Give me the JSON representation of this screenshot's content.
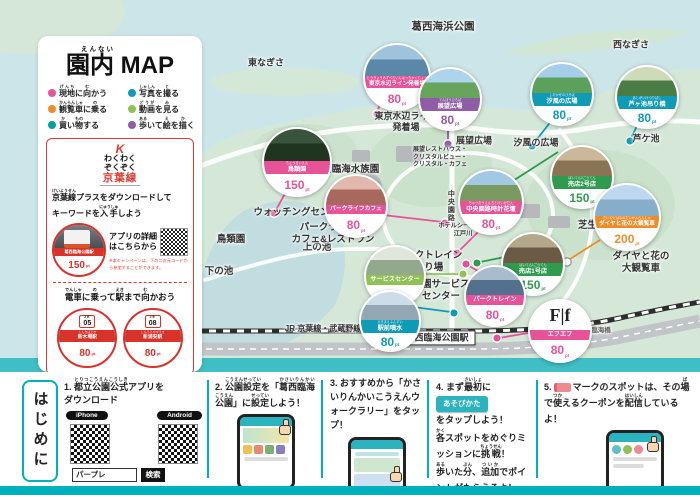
{
  "colors": {
    "teal": "#00b0ba",
    "red": "#dd3b30",
    "pink": "#e85298",
    "blue": "#0f9bb5",
    "purple": "#8f5ca6",
    "orange": "#ef8c2a",
    "green": "#2e9b4e",
    "light_green": "#8fc155",
    "dark_teal": "#00a297"
  },
  "left_panel": {
    "title": {
      "text": "園内 MAP",
      "furigana": "えんない"
    },
    "legend": [
      {
        "segs": [
          {
            "t": "現地",
            "r": "げんち"
          },
          {
            "t": "に"
          },
          {
            "t": "向",
            "r": "む"
          },
          {
            "t": "かう"
          }
        ],
        "color": "#e85298"
      },
      {
        "segs": [
          {
            "t": "写真",
            "r": "しゃしん"
          },
          {
            "t": "を"
          },
          {
            "t": "撮",
            "r": "と"
          },
          {
            "t": "る"
          }
        ],
        "color": "#0f9bb5"
      },
      {
        "segs": [
          {
            "t": "観覧車",
            "r": "かんらんしゃ"
          },
          {
            "t": "に"
          },
          {
            "t": "乗",
            "r": "の"
          },
          {
            "t": "る"
          }
        ],
        "color": "#ef8c2a"
      },
      {
        "segs": [
          {
            "t": "動画",
            "r": "どうが"
          },
          {
            "t": "を"
          },
          {
            "t": "見",
            "r": "み"
          },
          {
            "t": "る"
          }
        ],
        "color": "#8fc155"
      },
      {
        "segs": [
          {
            "t": "買",
            "r": "か"
          },
          {
            "t": "い"
          },
          {
            "t": "物",
            "r": "もの"
          },
          {
            "t": "する"
          }
        ],
        "color": "#00a297"
      },
      {
        "segs": [
          {
            "t": "歩",
            "r": "ある"
          },
          {
            "t": "いて"
          },
          {
            "t": "絵",
            "r": "え"
          },
          {
            "t": "を"
          },
          {
            "t": "描",
            "r": "か"
          },
          {
            "t": "く"
          }
        ],
        "color": "#8f5ca6"
      }
    ],
    "keiyo": {
      "logo_mark": "K",
      "logo_line1": "わくわく",
      "logo_line2": "ぞくぞく",
      "logo_line3": "京葉線",
      "headline": [
        {
          "t": "京葉線",
          "r": "けいようせん"
        },
        {
          "t": "プラスをダウンロードして\nキーワードを"
        },
        {
          "t": "入手",
          "r": "にゅうしゅ"
        },
        {
          "t": "しよう"
        }
      ],
      "station_badge": {
        "name": "葛西臨海公園駅",
        "points": "150",
        "unit": "pt"
      },
      "detail_line1": "アプリの詳細",
      "detail_line2": "はこちらから",
      "note": "※本キャンペーンは、下の二次元コードから参加することができます。",
      "train_heading": [
        {
          "t": "電車",
          "r": "でんしゃ"
        },
        {
          "t": "に"
        },
        {
          "t": "乗",
          "r": "の"
        },
        {
          "t": "って"
        },
        {
          "t": "駅",
          "r": "えき"
        },
        {
          "t": "まで"
        },
        {
          "t": "向",
          "r": "む"
        },
        {
          "t": "かおう"
        }
      ],
      "stations": [
        {
          "code_line": "JE",
          "code_num": "05",
          "furigana": "しんきばえき",
          "name": "新木場駅",
          "points": "80",
          "unit": "pt"
        },
        {
          "code_line": "JE",
          "code_num": "08",
          "furigana": "しんうらやすえき",
          "name": "新浦安駅",
          "points": "80",
          "unit": "pt"
        }
      ]
    }
  },
  "map": {
    "points_unit": "pt",
    "labels": [
      {
        "text": "葛西海浜公園",
        "x": 443,
        "y": 27,
        "size": 10.5
      },
      {
        "text": "東なぎさ",
        "x": 266,
        "y": 63,
        "size": 9
      },
      {
        "text": "西なぎさ",
        "x": 631,
        "y": 45,
        "size": 9
      },
      {
        "text": "東京水辺ライン\n発着場",
        "x": 406,
        "y": 122,
        "size": 9
      },
      {
        "text": "展望広場",
        "x": 474,
        "y": 141,
        "size": 9
      },
      {
        "text": "汐風の広場",
        "x": 536,
        "y": 143,
        "size": 9
      },
      {
        "text": "芦ケ池",
        "x": 646,
        "y": 139,
        "size": 9
      },
      {
        "text": "葛西臨海水族園",
        "x": 346,
        "y": 170,
        "size": 9.5
      },
      {
        "text": "展望レストハウス・\nクリスタルビュー・\nクリスタル・カフェ",
        "x": 440,
        "y": 158,
        "size": 6
      },
      {
        "text": "ウォッチングセンター",
        "x": 301,
        "y": 213,
        "size": 9.5
      },
      {
        "text": "鳥類園",
        "x": 231,
        "y": 240,
        "size": 9.5
      },
      {
        "text": "上の池",
        "x": 317,
        "y": 248,
        "size": 9.5
      },
      {
        "text": "下の池",
        "x": 219,
        "y": 272,
        "size": 9.5
      },
      {
        "text": "中央園路",
        "x": 450,
        "y": 206,
        "size": 7,
        "vertical": true
      },
      {
        "text": "ホテルシーサイド\n江戸川",
        "x": 463,
        "y": 230,
        "size": 6.2
      },
      {
        "text": "パークライフ・\nカフェ&レストラン",
        "x": 333,
        "y": 234,
        "size": 9.5
      },
      {
        "text": "パークトレイン\n乗り場",
        "x": 429,
        "y": 262,
        "size": 9.5
      },
      {
        "text": "公園サービス\nセンター",
        "x": 441,
        "y": 291,
        "size": 9.5
      },
      {
        "text": "芝生広場",
        "x": 597,
        "y": 226,
        "size": 9.5
      },
      {
        "text": "ダイヤと花の大観覧車",
        "x": 641,
        "y": 263,
        "size": 9.5
      },
      {
        "text": "臨海橋",
        "x": 601,
        "y": 331,
        "size": 6.5,
        "color": "#666"
      },
      {
        "text": "JR 京葉線・武蔵野線",
        "x": 323,
        "y": 329,
        "size": 8
      },
      {
        "text": "葛西臨海公園駅",
        "x": 437,
        "y": 338,
        "size": 9,
        "boxed": true
      }
    ],
    "spots": [
      {
        "name": "東京水辺ライン発着場",
        "furigana": "とうきょうみずべらいんはっちゃくじょう",
        "points": "80",
        "color": "#e85298",
        "x": 363,
        "y": 43,
        "d": 64,
        "photo": [
          "#9fc3dd",
          "#5b87a8"
        ]
      },
      {
        "name": "展望広場",
        "furigana": "てんぼうひろば",
        "points": "80",
        "color": "#8f5ca6",
        "x": 418,
        "y": 67,
        "d": 60,
        "photo": [
          "#aed3ec",
          "#67a45c"
        ]
      },
      {
        "name": "汐風の広場",
        "furigana": "しおかぜのひろば",
        "points": "80",
        "color": "#0f9bb5",
        "x": 530,
        "y": 62,
        "d": 60,
        "photo": [
          "#a5cee9",
          "#5ba05b"
        ]
      },
      {
        "name": "芦ヶ池吊り橋",
        "furigana": "あしがいけつりばし",
        "points": "80",
        "color": "#0f9bb5",
        "x": 615,
        "y": 65,
        "d": 60,
        "photo": [
          "#cddbb8",
          "#4a7c46"
        ]
      },
      {
        "name": "鳥類園",
        "furigana": "ちょうるいえん",
        "points": "150",
        "color": "#e85298",
        "x": 262,
        "y": 127,
        "d": 66,
        "photo": [
          "#39543c",
          "#20351f"
        ]
      },
      {
        "name": "パークライフカフェ",
        "points": "80",
        "color": "#e85298",
        "x": 324,
        "y": 174,
        "d": 60,
        "photo": [
          "#e0b8ad",
          "#a8685e"
        ]
      },
      {
        "name": "中央園路時計花壇",
        "furigana": "ちゅうおうえんろとけいかだん",
        "points": "80",
        "color": "#e85298",
        "x": 458,
        "y": 169,
        "d": 62,
        "photo": [
          "#a3c8e3",
          "#7a9a62"
        ]
      },
      {
        "name": "売店2号店",
        "furigana": "ばいてん2ごうてん",
        "points": "150",
        "color": "#2e9b4e",
        "x": 550,
        "y": 145,
        "d": 60,
        "photo": [
          "#cbb89b",
          "#8a7456"
        ]
      },
      {
        "name": "売店1号店",
        "furigana": "ばいてん1ごうてん",
        "points": "150",
        "color": "#2e9b4e",
        "x": 501,
        "y": 232,
        "d": 60,
        "photo": [
          "#b3a78c",
          "#6b5b44"
        ]
      },
      {
        "name": "ダイヤと花の大観覧車",
        "furigana": "だいやとはなのだいかんらんしゃ",
        "points": "200",
        "color": "#ef8c2a",
        "x": 593,
        "y": 183,
        "d": 64,
        "photo": [
          "#bcd8ee",
          "#86aecb"
        ]
      },
      {
        "name": "サービスセンター",
        "points": "80",
        "color": "#8fc155",
        "x": 364,
        "y": 245,
        "d": 58,
        "photo": [
          "#dfe7da",
          "#93a88c"
        ]
      },
      {
        "name": "パークトレイン",
        "points": "80",
        "color": "#e85298",
        "x": 464,
        "y": 265,
        "d": 58,
        "photo": [
          "#a9bccb",
          "#53718e"
        ]
      },
      {
        "name": "駅前噴水",
        "furigana": "えきまえふんすい",
        "points": "80",
        "color": "#0f9bb5",
        "x": 359,
        "y": 290,
        "d": 58,
        "photo": [
          "#ccdde8",
          "#93a7b5"
        ]
      },
      {
        "name": "エフエフ",
        "points": "80",
        "color": "#e85298",
        "x": 528,
        "y": 299,
        "d": 60,
        "logo": "F|f"
      }
    ],
    "connectors": {
      "lines": [
        {
          "x1": 380,
          "y1": 104,
          "x2": 377,
          "y2": 112,
          "c": "#e85298"
        },
        {
          "x1": 448,
          "y1": 128,
          "x2": 448,
          "y2": 141,
          "c": "#8f5ca6"
        },
        {
          "x1": 552,
          "y1": 120,
          "x2": 534,
          "y2": 143,
          "c": "#0f9bb5"
        },
        {
          "x1": 638,
          "y1": 124,
          "x2": 631,
          "y2": 138,
          "c": "#0f9bb5"
        },
        {
          "x1": 288,
          "y1": 188,
          "x2": 276,
          "y2": 210,
          "c": "#e85298"
        },
        {
          "x1": 383,
          "y1": 215,
          "x2": 443,
          "y2": 222,
          "c": "#e85298"
        },
        {
          "x1": 481,
          "y1": 229,
          "x2": 460,
          "y2": 250,
          "c": "#e85298"
        },
        {
          "x1": 558,
          "y1": 152,
          "x2": 491,
          "y2": 195,
          "c": "#2e9b4e"
        },
        {
          "x1": 505,
          "y1": 257,
          "x2": 480,
          "y2": 262,
          "c": "#2e9b4e"
        },
        {
          "x1": 600,
          "y1": 240,
          "x2": 570,
          "y2": 259,
          "c": "#ef8c2a"
        },
        {
          "x1": 422,
          "y1": 274,
          "x2": 461,
          "y2": 274,
          "c": "#8fc155"
        },
        {
          "x1": 478,
          "y1": 271,
          "x2": 469,
          "y2": 266,
          "c": "#e85298"
        },
        {
          "x1": 406,
          "y1": 306,
          "x2": 451,
          "y2": 312,
          "c": "#0f9bb5"
        },
        {
          "x1": 499,
          "y1": 338,
          "x2": 528,
          "y2": 333,
          "c": "#e85298"
        }
      ],
      "dots": [
        {
          "x": 377,
          "y": 114,
          "c": "#e85298"
        },
        {
          "x": 448,
          "y": 144,
          "c": "#8f5ca6"
        },
        {
          "x": 532,
          "y": 146,
          "c": "#0f9bb5"
        },
        {
          "x": 630,
          "y": 141,
          "c": "#0f9bb5"
        },
        {
          "x": 274,
          "y": 213,
          "c": "#e85298"
        },
        {
          "x": 445,
          "y": 223,
          "c": "#e85298"
        },
        {
          "x": 457,
          "y": 253,
          "c": "#e85298"
        },
        {
          "x": 488,
          "y": 197,
          "c": "#2e9b4e"
        },
        {
          "x": 477,
          "y": 263,
          "c": "#2e9b4e"
        },
        {
          "x": 567,
          "y": 262,
          "c": "#ffffff",
          "stroke": "#999"
        },
        {
          "x": 463,
          "y": 274,
          "c": "#8fc155"
        },
        {
          "x": 466,
          "y": 264,
          "c": "#e85298"
        },
        {
          "x": 454,
          "y": 313,
          "c": "#0f9bb5"
        },
        {
          "x": 497,
          "y": 338,
          "c": "#e85298"
        }
      ]
    }
  },
  "intro": {
    "heading": "はじめに",
    "step1": {
      "line1": [
        {
          "t": "1. "
        },
        {
          "t": "都立公園公式",
          "r": "とりつこうえんこうしき"
        },
        {
          "t": "アプリを"
        }
      ],
      "line2": "ダウンロード",
      "pills": [
        "iPhone",
        "Android"
      ],
      "search_value": "パープレ",
      "search_button": "検索"
    },
    "step2": {
      "text": [
        {
          "t": "2. "
        },
        {
          "t": "公園設定",
          "r": "こうえんせってい"
        },
        {
          "t": "を「"
        },
        {
          "t": "葛西臨海",
          "r": "かさいりんかい"
        },
        {
          "t": "公園",
          "r": "こうえん"
        },
        {
          "t": "」に"
        },
        {
          "t": "設定",
          "r": "せってい"
        },
        {
          "t": "しよう！"
        }
      ]
    },
    "step3": {
      "text": [
        {
          "t": "3. おすすめから「かさいりんかいこうえんウォークラリー」をタップ！"
        }
      ]
    },
    "step4": {
      "line1": [
        {
          "t": "4. まず"
        },
        {
          "t": "最初",
          "r": "さいしょ"
        },
        {
          "t": "に"
        }
      ],
      "button": "あそびかた",
      "line2": "をタップしよう！",
      "line3": [
        {
          "t": "各",
          "r": "かく"
        },
        {
          "t": "スポットをめぐりミッションに"
        },
        {
          "t": "挑戦",
          "r": "ちょうせん"
        },
        {
          "t": "！"
        }
      ],
      "line4": [
        {
          "t": "歩",
          "r": "ある"
        },
        {
          "t": "いた"
        },
        {
          "t": "分",
          "r": "ぶん"
        },
        {
          "t": "、"
        },
        {
          "t": "追加",
          "r": "ついか"
        },
        {
          "t": "でポイントがもらえるよ！"
        }
      ]
    },
    "step5": {
      "prefix": "5.",
      "text": [
        {
          "t": "マークのスポットは、その"
        },
        {
          "t": "場",
          "r": "ば"
        },
        {
          "t": "で"
        },
        {
          "t": "使",
          "r": "つか"
        },
        {
          "t": "えるクーポンを"
        },
        {
          "t": "配信",
          "r": "はいしん"
        },
        {
          "t": "しているよ！"
        }
      ]
    }
  }
}
